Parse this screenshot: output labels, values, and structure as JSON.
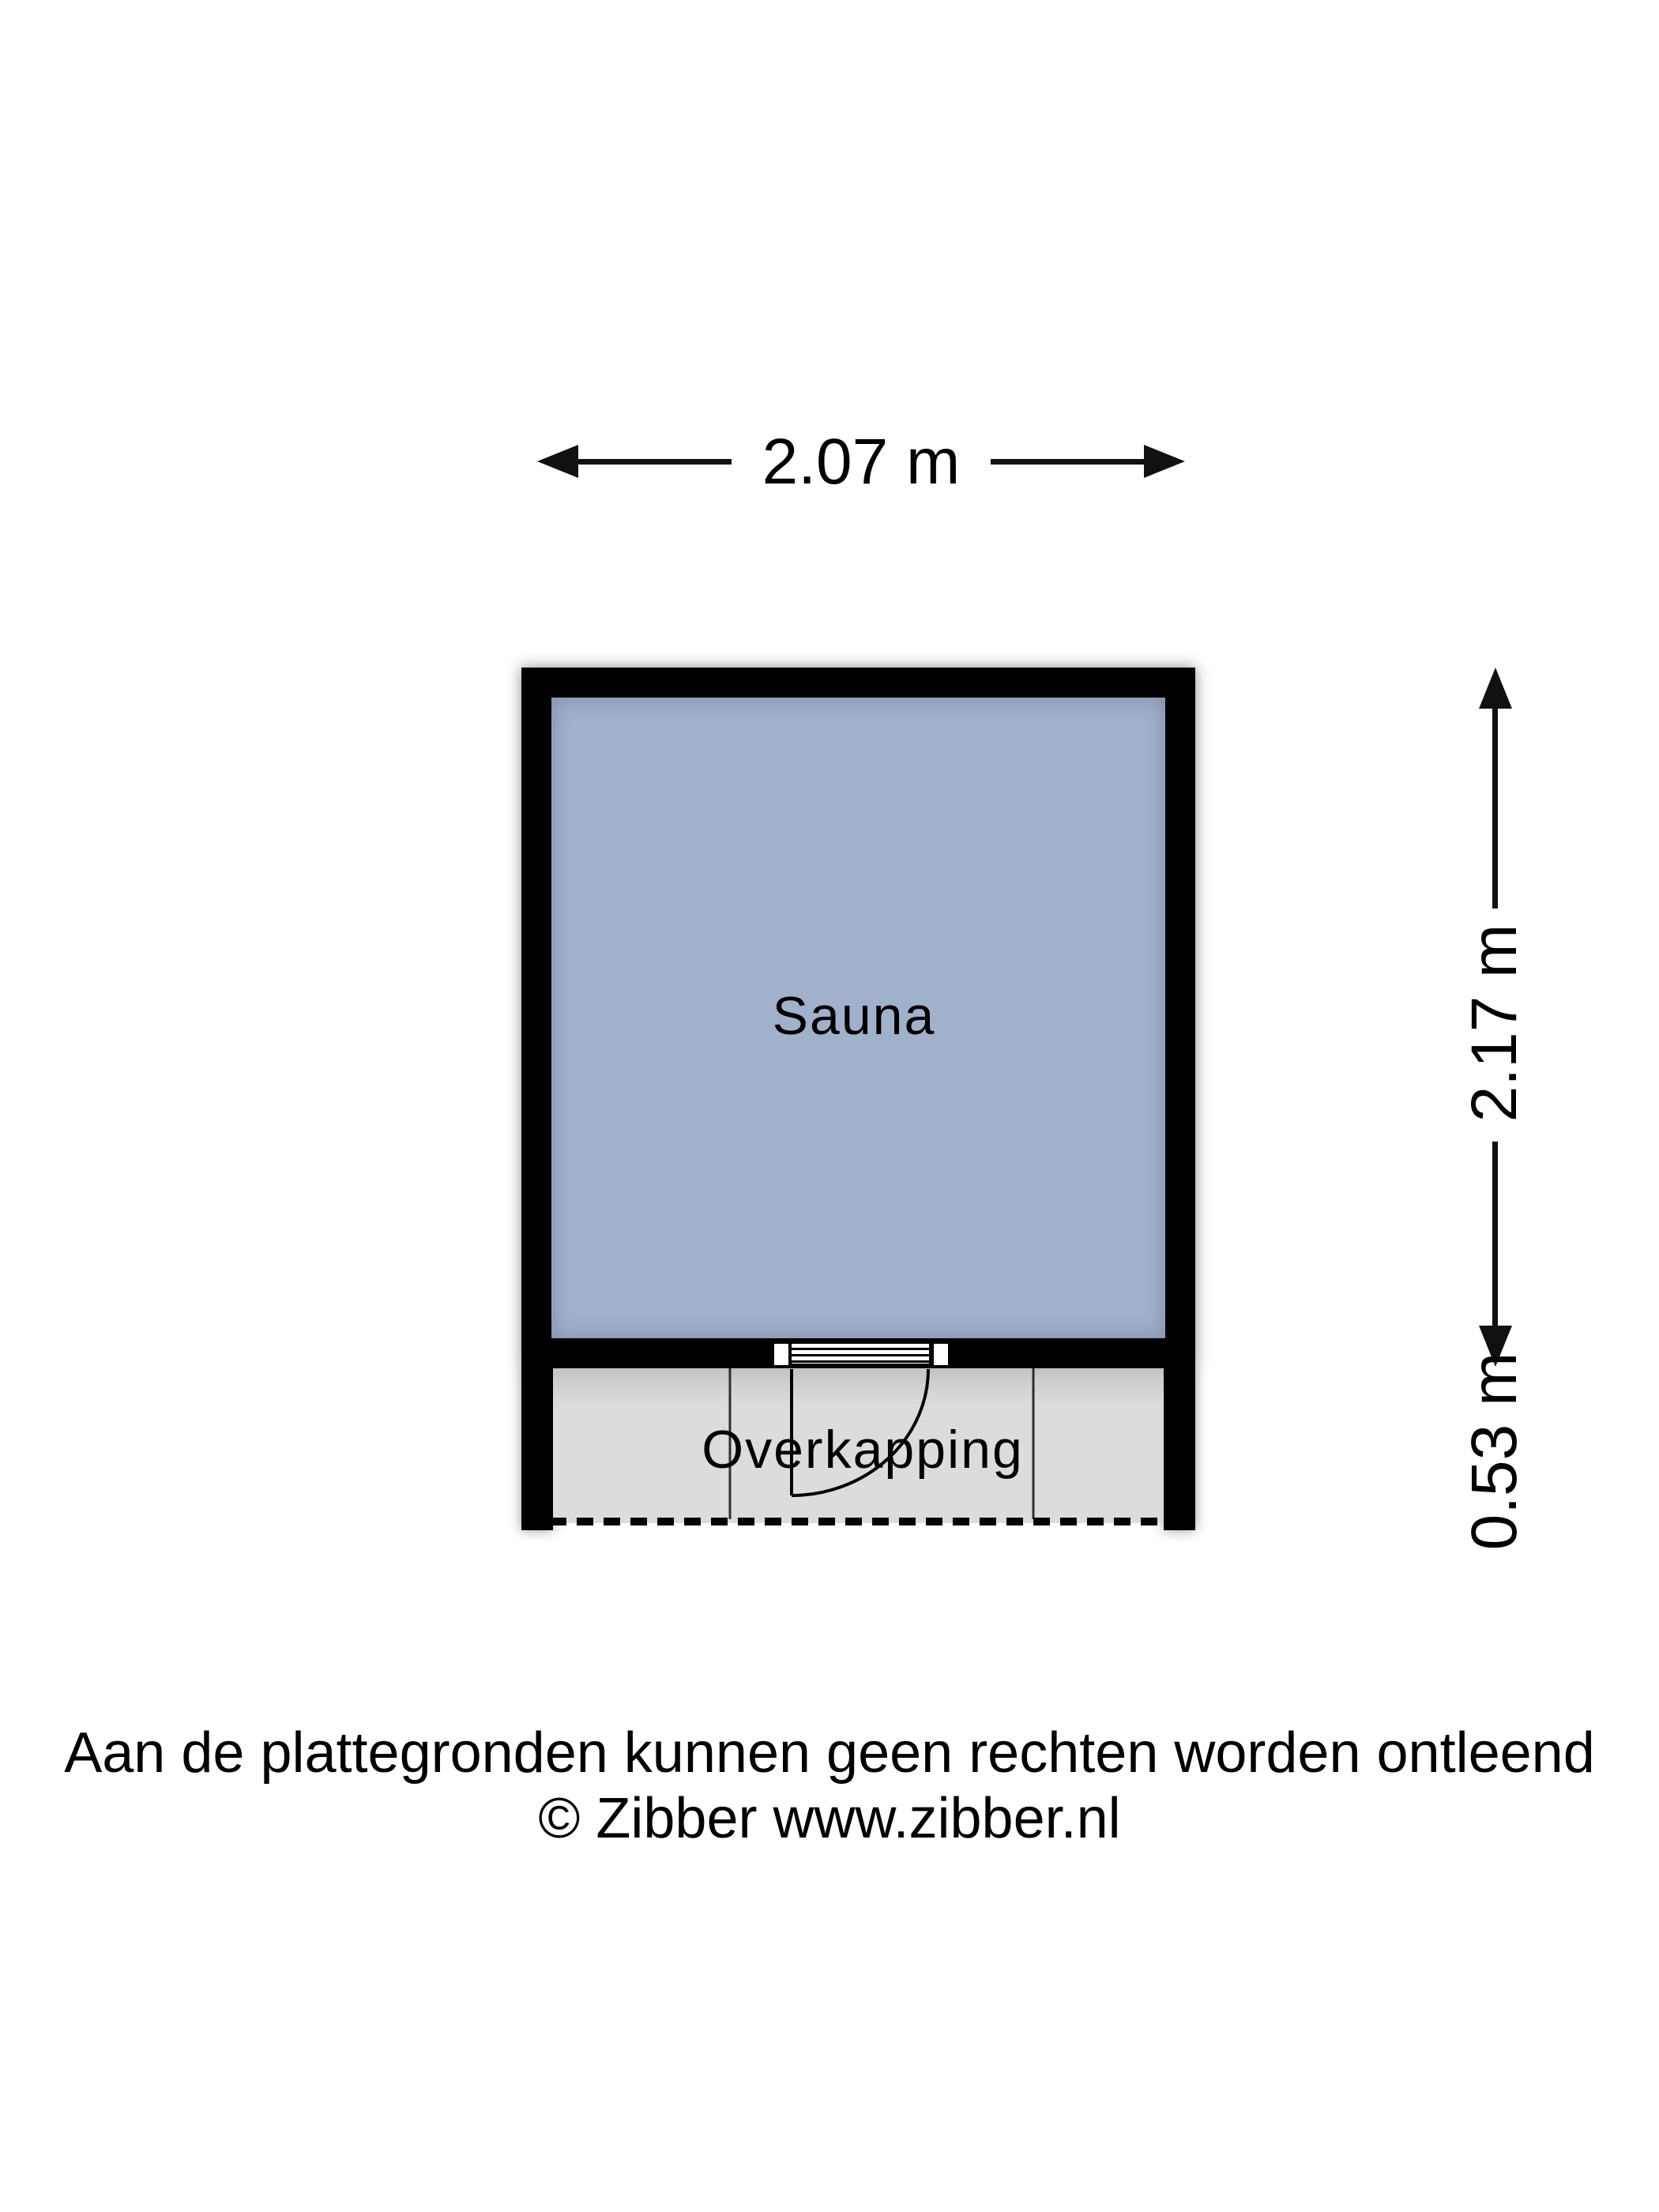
{
  "dimensions": {
    "width": "2.07 m",
    "sauna_depth": "2.17 m",
    "overkapping_depth": "0.53 m"
  },
  "rooms": {
    "sauna": {
      "label": "Sauna",
      "fill": "#a1b0cb"
    },
    "overkapping": {
      "label": "Overkapping",
      "fill": "#dcdcdc"
    }
  },
  "colors": {
    "wall": "#000000",
    "dimension_lines": "#111111",
    "dashed_boundary": "#000000"
  },
  "disclaimer": {
    "line1": "Aan de plattegronden kunnen geen rechten worden ontleend",
    "line2": "© Zibber www.zibber.nl"
  }
}
